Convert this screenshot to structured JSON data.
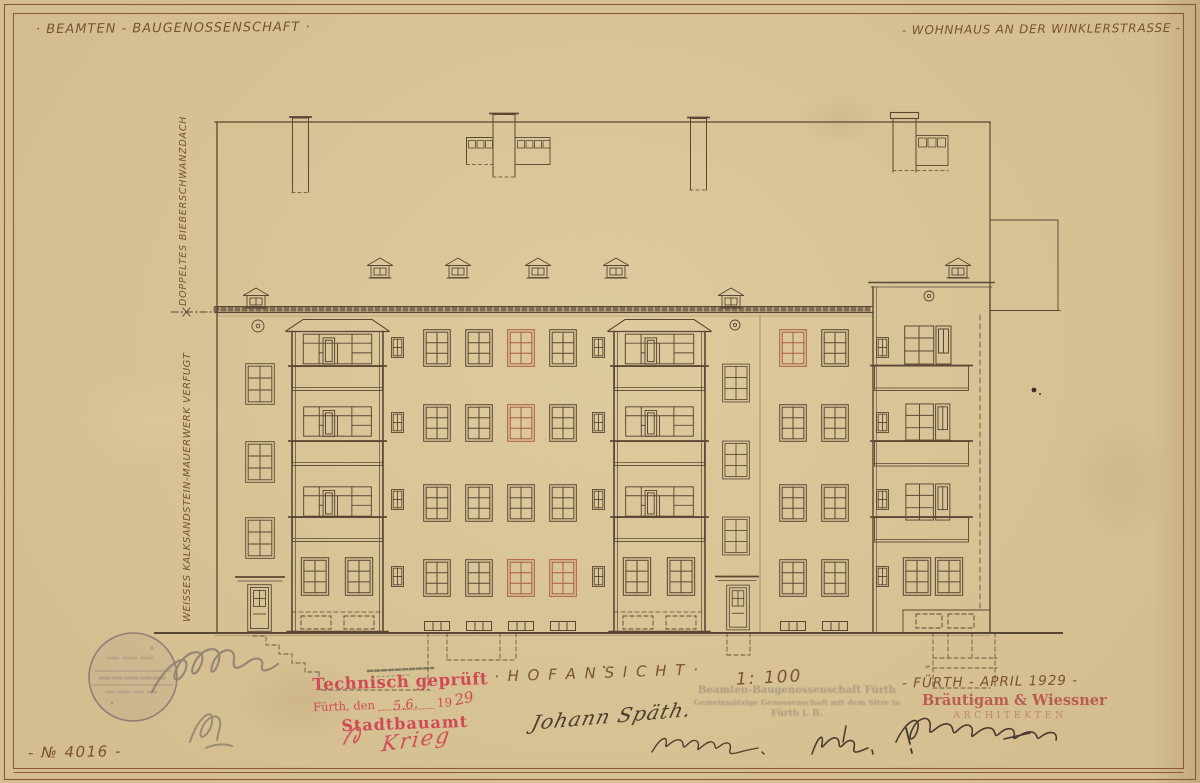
{
  "sheet": {
    "paper_color": "#d4be90",
    "ink_color": "#5a4733",
    "red_chalk_color": "#aa5a3c",
    "stamp_red_color": "#cf4a56",
    "pencil_color": "#8b7e6c",
    "ink_signature_color": "#4a3b2c"
  },
  "header": {
    "left_title": "· BEAMTEN - BAUGENOSSENSCHAFT ·",
    "right_title": "- WOHNHAUS AN DER WINKLERSTRASSE -"
  },
  "margin_notes": {
    "roof_note": "DOPPELTES BIEBERSCHWANZDACH",
    "masonry_note": "WEISSES KALKSANDSTEIN-MAUERWERK VERFUGT"
  },
  "footer": {
    "view_title": "· H O F A N S I C H T ·",
    "scale_label": "1: 100",
    "sheet_number": "- № 4016 -"
  },
  "approval_stamp": {
    "line1": "Technisch geprüft",
    "city_prefix": "Fürth, den",
    "date_handwritten": "5.6.",
    "century": "19",
    "year_handwritten": "29",
    "office": "Stadtbauamt",
    "signature": "Krieg"
  },
  "architect_block": {
    "ditto_mark": "″",
    "location_date": "- FÜRTH - APRIL 1929 -",
    "firm_name": "Bräutigam & Wiessner",
    "firm_title": "ARCHITEKTEN"
  },
  "signatures": {
    "owner_signature": "Johann Späth."
  },
  "faded_stamp": {
    "line1": "Beamten-Baugenossenschaft Fürth",
    "line2": "Gemeinnützige Genossenschaft mit dem Sitze in",
    "line3": "Fürth i. B."
  }
}
